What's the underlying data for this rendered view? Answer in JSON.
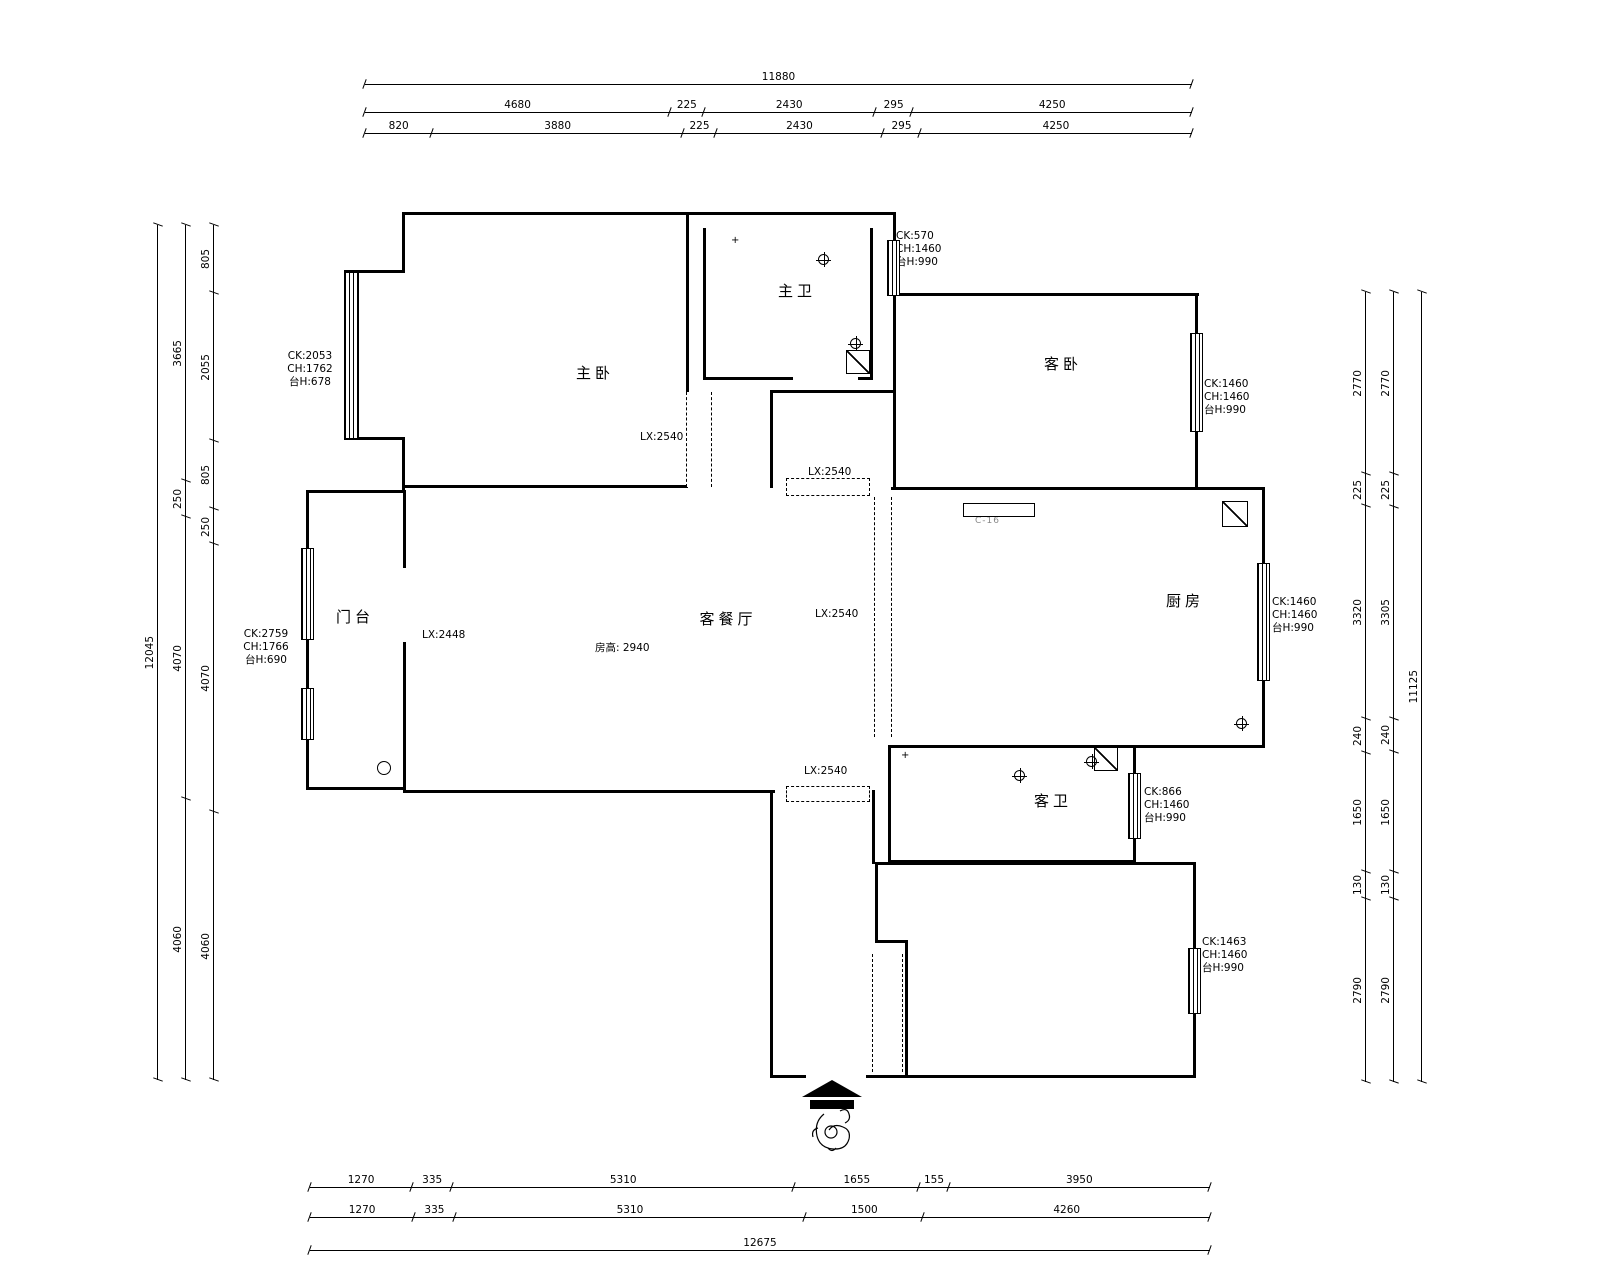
{
  "plan": {
    "rooms": {
      "master_bedroom": "主卧",
      "master_bath": "主卫",
      "guest_bedroom": "客卧",
      "kitchen": "厨房",
      "living_dining": "客餐厅",
      "porch": "门台",
      "guest_bath": "客卫"
    },
    "room_height_label": "房高: 2940",
    "notch_label": "C-16",
    "window_specs": {
      "top_right": [
        "CK:570",
        "CH:1460",
        "台H:990"
      ],
      "master_bay": [
        "CK:2053",
        "CH:1762",
        "台H:678"
      ],
      "porch_left": [
        "CK:2759",
        "CH:1766",
        "台H:690"
      ],
      "guest_bedroom_right": [
        "CK:1460",
        "CH:1460",
        "台H:990"
      ],
      "kitchen_right": [
        "CK:1460",
        "CH:1460",
        "台H:990"
      ],
      "guest_bath_right": [
        "CK:866",
        "CH:1460",
        "台H:990"
      ],
      "bottom_bedroom_right": [
        "CK:1463",
        "CH:1460",
        "台H:990"
      ]
    },
    "openings": {
      "master_closet": "LX:2540",
      "passage_top": "LX:2540",
      "kitchen_corridor": "LX:2540",
      "living_corridor": "LX:2540",
      "living_width": "LX:2448"
    }
  },
  "dimensions": {
    "top": {
      "total": [
        11880
      ],
      "row2": [
        4680,
        225,
        2430,
        295,
        4250
      ],
      "row3": [
        820,
        3880,
        225,
        2430,
        295,
        4250
      ]
    },
    "left": {
      "total": [
        12045
      ],
      "mid": [
        3665,
        250,
        4070,
        4060
      ],
      "inner": [
        805,
        2055,
        805,
        250,
        4070,
        4060
      ]
    },
    "right": {
      "inner": [
        2770,
        225,
        3320,
        240,
        1650,
        130,
        2790
      ],
      "mid": [
        2770,
        225,
        3305,
        240,
        1650,
        130,
        2790
      ],
      "total": [
        11125
      ]
    },
    "bottom": {
      "row1": [
        1270,
        335,
        5310,
        1655,
        155,
        3950
      ],
      "row2": [
        1270,
        335,
        5310,
        1500,
        4260
      ],
      "total": [
        12675
      ]
    }
  }
}
